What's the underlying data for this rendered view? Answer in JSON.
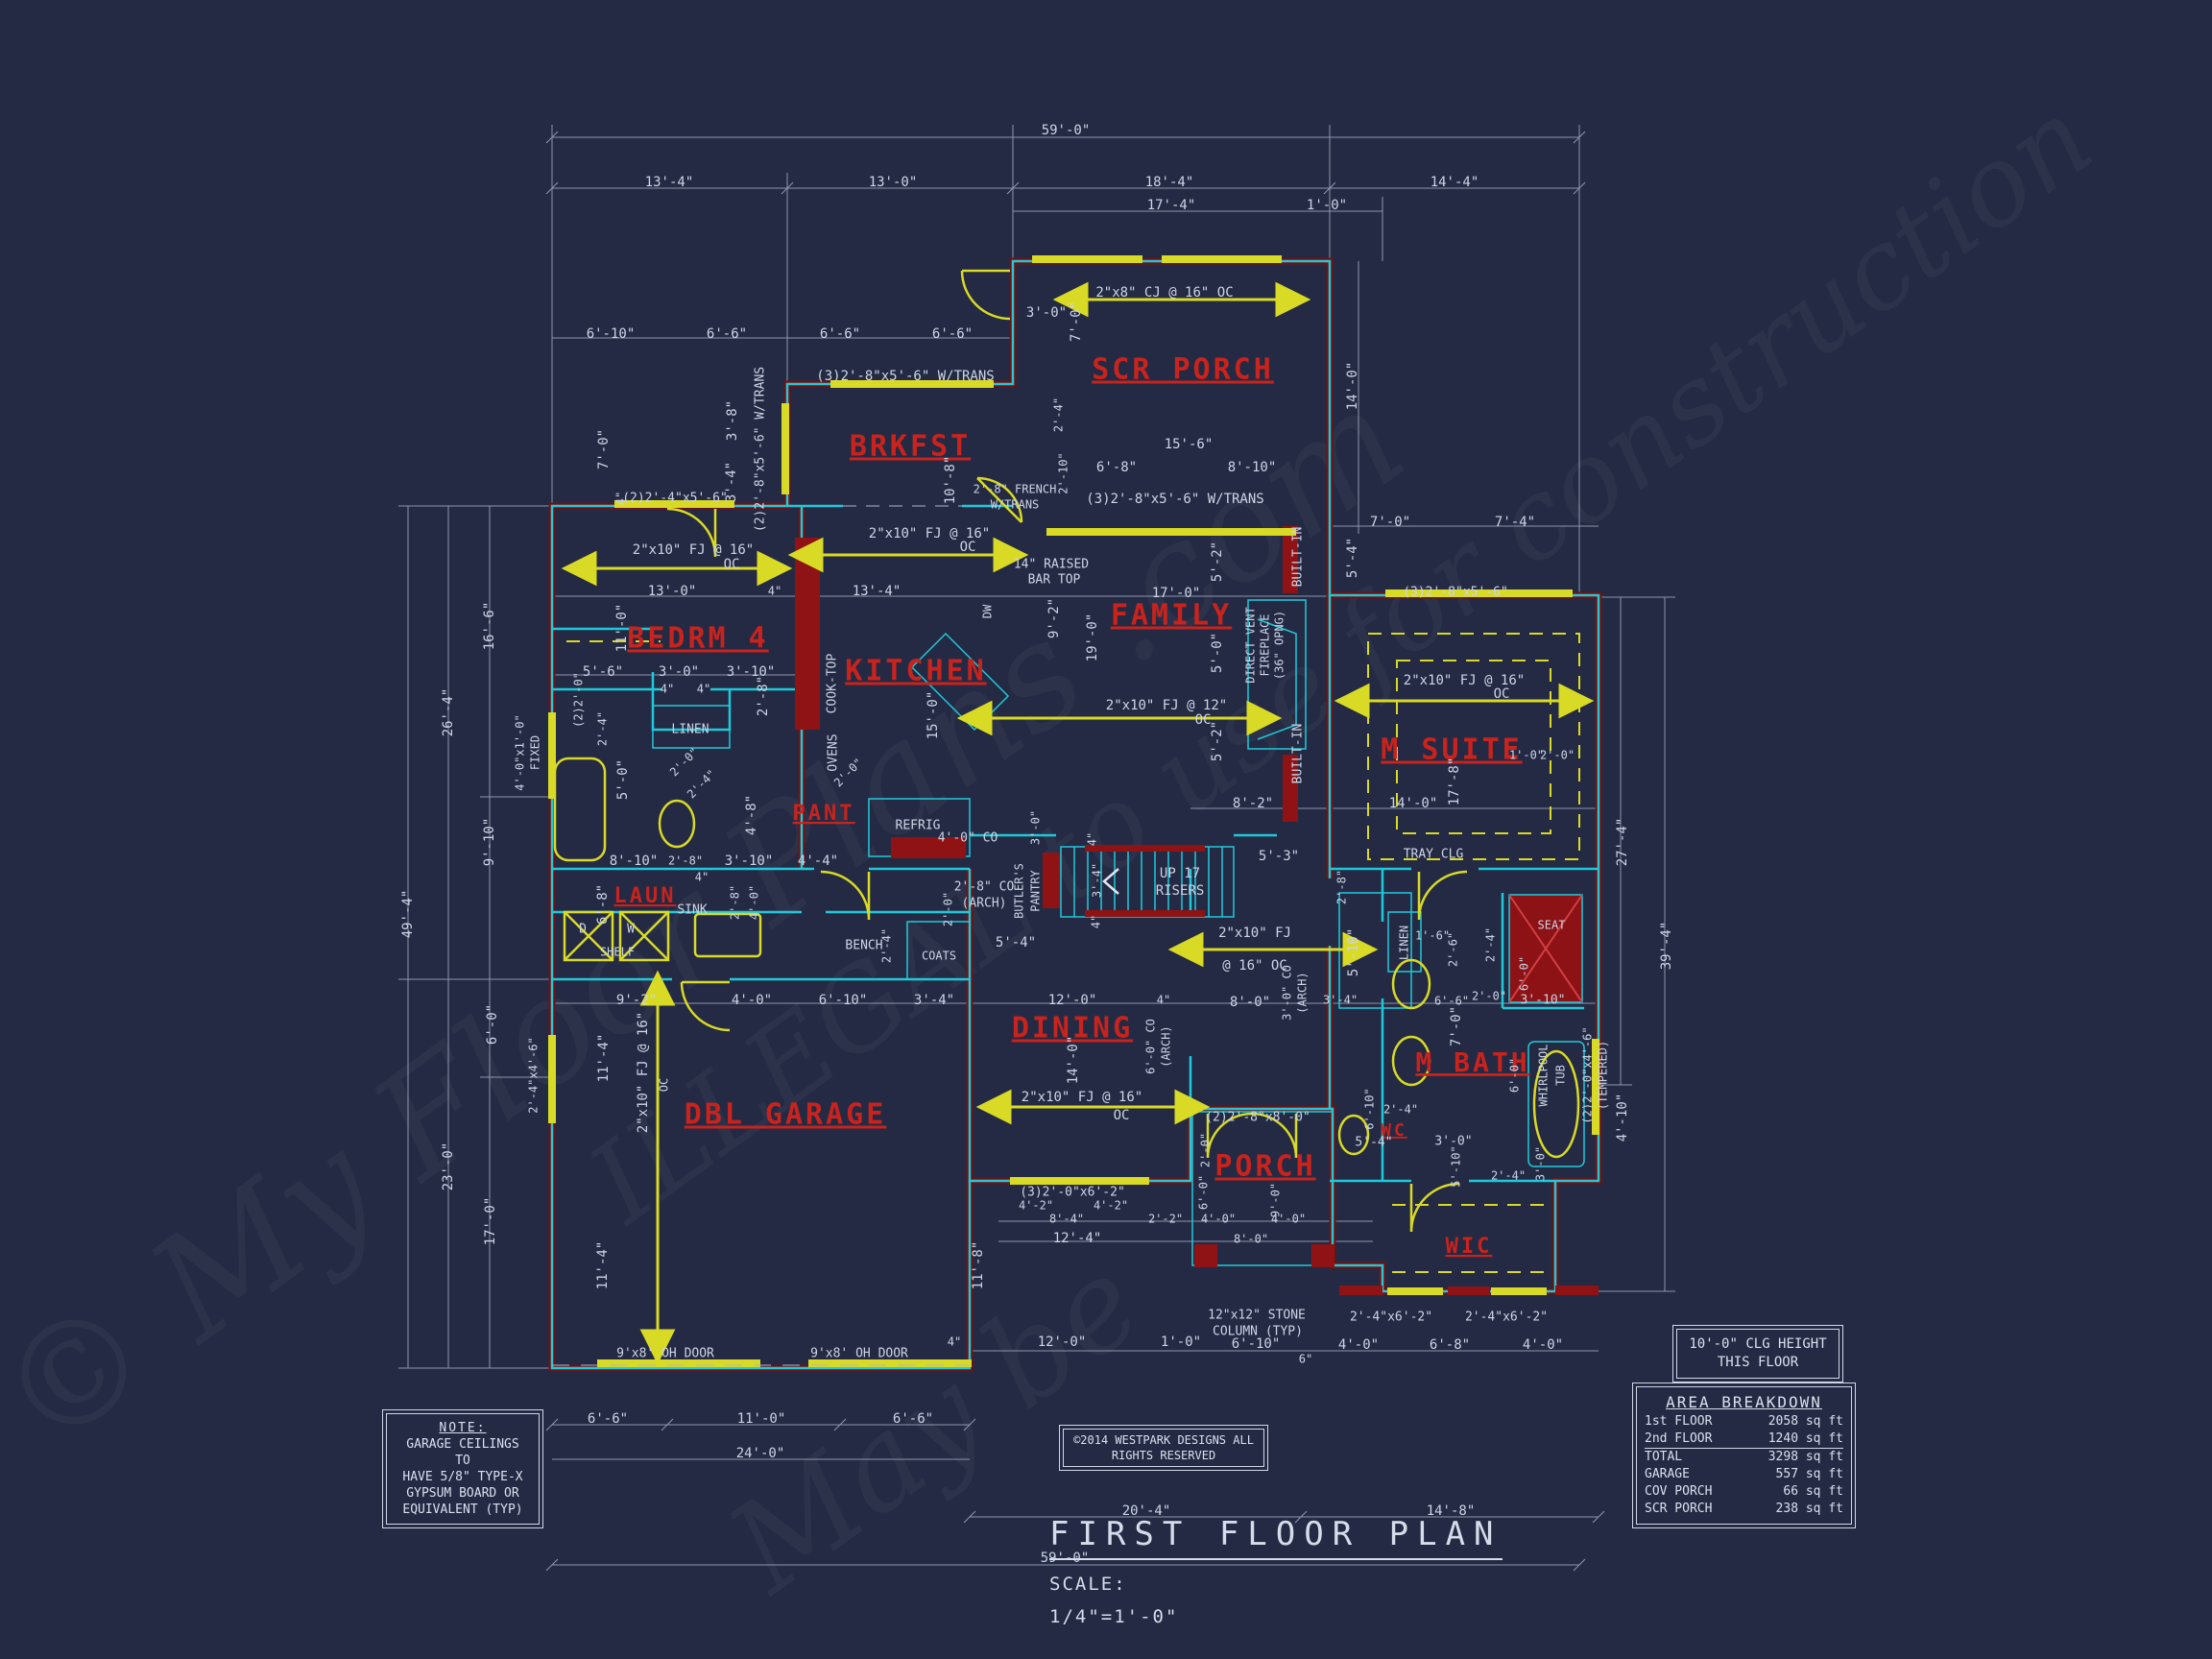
{
  "header": {
    "title": "FIRST FLOOR PLAN",
    "scale_label": "SCALE:",
    "scale_value": "1/4\"=1'-0\""
  },
  "note_box": {
    "heading": "NOTE:",
    "lines": [
      "GARAGE CEILINGS TO",
      "HAVE 5/8\" TYPE-X",
      "GYPSUM BOARD OR",
      "EQUIVALENT (TYP)"
    ]
  },
  "clg_box": {
    "line1": "10'-0\" CLG HEIGHT",
    "line2": "THIS FLOOR"
  },
  "copyright_box": {
    "line1": "©2014 WESTPARK DESIGNS ALL",
    "line2": "RIGHTS RESERVED"
  },
  "area_table": {
    "title": "AREA BREAKDOWN",
    "rows": [
      {
        "label": "1st FLOOR",
        "value": "2058 sq ft"
      },
      {
        "label": "2nd FLOOR",
        "value": "1240 sq ft"
      },
      {
        "label": "TOTAL",
        "value": "3298 sq ft"
      },
      {
        "label": "GARAGE",
        "value": "557 sq ft"
      },
      {
        "label": "COV PORCH",
        "value": "66 sq ft"
      },
      {
        "label": "SCR PORCH",
        "value": "238 sq ft"
      }
    ]
  },
  "watermarks": [
    {
      "t": "© My Floor Plans .com"
    },
    {
      "t": "ILLEGAL to use for construction"
    },
    {
      "t": "May be"
    }
  ],
  "plan_labels": [
    [
      "SCR PORCH",
      1232,
      386,
      0,
      30,
      "r"
    ],
    [
      "BRKFST",
      948,
      466,
      0,
      30,
      "r"
    ],
    [
      "BEDRM 4",
      727,
      666,
      0,
      30,
      "r"
    ],
    [
      "KITCHEN",
      954,
      700,
      0,
      30,
      "r"
    ],
    [
      "FAMILY",
      1220,
      642,
      0,
      30,
      "r"
    ],
    [
      "M SUITE",
      1512,
      782,
      0,
      30,
      "r"
    ],
    [
      "DINING",
      1117,
      1072,
      0,
      30,
      "r"
    ],
    [
      "DBL GARAGE",
      818,
      1162,
      0,
      30,
      "r"
    ],
    [
      "PORCH",
      1318,
      1216,
      0,
      30,
      "r"
    ],
    [
      "M BATH",
      1534,
      1108,
      0,
      28,
      "r"
    ],
    [
      "PANT",
      858,
      848,
      0,
      22,
      "r"
    ],
    [
      "LAUN",
      672,
      934,
      0,
      22,
      "r"
    ],
    [
      "WC",
      1452,
      1178,
      0,
      18,
      "r"
    ],
    [
      "WIC",
      1530,
      1299,
      0,
      22,
      "r"
    ],
    [
      "59'-0\"",
      1110,
      136
    ],
    [
      "13'-4\"",
      697,
      190
    ],
    [
      "13'-0\"",
      930,
      190
    ],
    [
      "18'-4\"",
      1218,
      190
    ],
    [
      "14'-4\"",
      1515,
      190
    ],
    [
      "17'-4\"",
      1220,
      214
    ],
    [
      "1'-0\"",
      1382,
      214
    ],
    [
      "2\"x8\" CJ @ 16\" OC",
      1213,
      305
    ],
    [
      "3'-0\"",
      1090,
      326
    ],
    [
      "7'-0\"",
      1121,
      335,
      -90
    ],
    [
      "14'-0\"",
      1409,
      402,
      -90
    ],
    [
      "2'-4\"",
      1103,
      432,
      -90,
      12
    ],
    [
      "2'-10\"",
      1108,
      493,
      -90,
      12
    ],
    [
      "15'-6\"",
      1238,
      463
    ],
    [
      "6'-8\"",
      1163,
      487
    ],
    [
      "8'-10\"",
      1304,
      487
    ],
    [
      "(3)2'-8\"x5'-6\" W/TRANS",
      1224,
      520
    ],
    [
      "6'-10\"",
      636,
      348
    ],
    [
      "6'-6\"",
      757,
      348
    ],
    [
      "6'-6\"",
      875,
      348
    ],
    [
      "6'-6\"",
      992,
      348
    ],
    [
      "7'-0\"",
      629,
      468,
      -90
    ],
    [
      "3'-8\"",
      763,
      438,
      -90
    ],
    [
      "3'-4\"",
      762,
      502,
      -90
    ],
    [
      "4\"",
      647,
      519,
      -90,
      12
    ],
    [
      "(2)2'-8\"x5'-6\" W/TRANS",
      792,
      468,
      -90,
      13
    ],
    [
      "(2)2'-4\"x5'-6\"",
      703,
      519,
      0,
      13
    ],
    [
      "(3)2'-8\"x5'-6\" W/TRANS",
      943,
      392
    ],
    [
      "10'-8\"",
      990,
      500,
      -90
    ],
    [
      "2'-8\" FRENCH",
      1057,
      510,
      0,
      12
    ],
    [
      "W/TRANS",
      1057,
      526,
      0,
      12
    ],
    [
      "2\"x10\" FJ @ 16\"",
      968,
      556
    ],
    [
      "OC",
      1008,
      570
    ],
    [
      "2\"x10\" FJ @ 16\"",
      722,
      573
    ],
    [
      "OC",
      762,
      588
    ],
    [
      "14\" RAISED",
      1095,
      588,
      0,
      13
    ],
    [
      "BAR TOP",
      1098,
      604,
      0,
      13
    ],
    [
      "13'-0\"",
      700,
      616
    ],
    [
      "4\"",
      807,
      616,
      0,
      12
    ],
    [
      "13'-4\"",
      913,
      616
    ],
    [
      "11'-0\"",
      648,
      654,
      -90
    ],
    [
      "9'-2\"",
      1098,
      644,
      -90
    ],
    [
      "19'-0\"",
      1138,
      664,
      -90
    ],
    [
      "DW",
      1029,
      637,
      -90,
      12
    ],
    [
      "5'-6\"",
      628,
      700
    ],
    [
      "3'-0\"",
      707,
      700
    ],
    [
      "3'-10\"",
      782,
      700
    ],
    [
      "4\"",
      695,
      718,
      0,
      12
    ],
    [
      "4\"",
      733,
      718,
      0,
      12
    ],
    [
      "2'-8\"",
      795,
      725,
      -90
    ],
    [
      "(2)2'-0\"",
      603,
      729,
      -90,
      12
    ],
    [
      "2'-4\"",
      628,
      759,
      -90,
      12
    ],
    [
      "LINEN",
      719,
      760,
      0,
      13
    ],
    [
      "5'-0\"",
      649,
      812,
      -90
    ],
    [
      "2'-0\"",
      713,
      794,
      -45,
      12
    ],
    [
      "2'-4\"",
      731,
      817,
      -45,
      12
    ],
    [
      "2'-0\"",
      884,
      805,
      -45,
      12
    ],
    [
      "COOK-TOP",
      867,
      712,
      -90,
      13
    ],
    [
      "OVENS",
      868,
      784,
      -90,
      13
    ],
    [
      "15'-0\"",
      972,
      745,
      -90
    ],
    [
      "4'-8\"",
      783,
      849,
      -90
    ],
    [
      "REFRIG",
      956,
      860,
      0,
      13
    ],
    [
      "17'-0\"",
      1225,
      618
    ],
    [
      "5'-2\"",
      1268,
      585,
      -90
    ],
    [
      "5'-0\"",
      1268,
      680,
      -90
    ],
    [
      "5'-2\"",
      1268,
      772,
      -90
    ],
    [
      "BUILT-IN",
      1352,
      580,
      -90,
      13
    ],
    [
      "BUILT-IN",
      1352,
      785,
      -90,
      13
    ],
    [
      "DIRECT VENT",
      1303,
      672,
      -90,
      12
    ],
    [
      "FIREPLACE",
      1318,
      672,
      -90,
      12
    ],
    [
      "(36\" OPNG)",
      1333,
      672,
      -90,
      12
    ],
    [
      "2\"x10\" FJ @ 12\"",
      1215,
      735
    ],
    [
      "OC",
      1253,
      750
    ],
    [
      "7'-0\"",
      1448,
      544
    ],
    [
      "7'-4\"",
      1578,
      544
    ],
    [
      "5'-4\"",
      1409,
      581,
      -90
    ],
    [
      "(3)2'-8\"x5'-6\"",
      1516,
      617,
      0,
      13
    ],
    [
      "2\"x10\" FJ @ 16\"",
      1525,
      709
    ],
    [
      "OC",
      1564,
      723
    ],
    [
      "1'-0\"",
      1590,
      787,
      0,
      12
    ],
    [
      "2'-0\"",
      1622,
      787,
      0,
      12
    ],
    [
      "17'-8\"",
      1515,
      814,
      -90
    ],
    [
      "8'-2\"",
      1305,
      837
    ],
    [
      "14'-0\"",
      1472,
      837
    ],
    [
      "TRAY CLG",
      1493,
      890,
      0,
      13
    ],
    [
      "27'-4\"",
      1690,
      877,
      -90
    ],
    [
      "39'-4\"",
      1736,
      985,
      -90
    ],
    [
      "8'-10\"",
      660,
      897
    ],
    [
      "2'-8\"",
      714,
      897,
      0,
      12
    ],
    [
      "3'-10\"",
      780,
      897
    ],
    [
      "4'-4\"",
      852,
      897
    ],
    [
      "4\"",
      731,
      914,
      0,
      12
    ],
    [
      "6'-8\"",
      628,
      942,
      -90
    ],
    [
      "2'-8\"",
      766,
      940,
      -90,
      12
    ],
    [
      "4'-0\"",
      786,
      940,
      -90,
      12
    ],
    [
      "SINK",
      721,
      948,
      0,
      13
    ],
    [
      "D",
      607,
      968,
      0,
      13
    ],
    [
      "W",
      657,
      968,
      0,
      13
    ],
    [
      "SHELF",
      643,
      992,
      0,
      12
    ],
    [
      "BENCH",
      900,
      985,
      0,
      13
    ],
    [
      "2'-4\"",
      924,
      985,
      -90,
      12
    ],
    [
      "2'-0\"",
      988,
      947,
      -90,
      12
    ],
    [
      "COATS",
      978,
      996,
      0,
      12
    ],
    [
      "4'-0\" CO",
      1008,
      873,
      0,
      13
    ],
    [
      "3'-0\"",
      1079,
      862,
      -90,
      12
    ],
    [
      "2'-8\" CO",
      1025,
      924,
      0,
      13
    ],
    [
      "(ARCH)",
      1025,
      941,
      0,
      13
    ],
    [
      "BUTLER'S",
      1062,
      928,
      -90,
      12
    ],
    [
      "PANTRY",
      1079,
      928,
      -90,
      12
    ],
    [
      "4\"",
      1138,
      874,
      -90,
      12
    ],
    [
      "3'-4\"",
      1143,
      917,
      -90,
      12
    ],
    [
      "4\"",
      1142,
      960,
      -90,
      12
    ],
    [
      "UP 17",
      1229,
      910
    ],
    [
      "RISERS",
      1229,
      928
    ],
    [
      "5'-3\"",
      1332,
      892
    ],
    [
      "5'-4\"",
      1058,
      982
    ],
    [
      "2'-8\"",
      1398,
      924,
      -90,
      12
    ],
    [
      "5'-10\"",
      1410,
      992,
      -90
    ],
    [
      "2\"x10\" FJ",
      1307,
      972
    ],
    [
      "@ 16\" OC",
      1307,
      1006
    ],
    [
      "3'-0\" CO",
      1341,
      1034,
      -90,
      12
    ],
    [
      "(ARCH)",
      1357,
      1034,
      -90,
      12
    ],
    [
      "12'-0\"",
      1117,
      1042
    ],
    [
      "4\"",
      1212,
      1042,
      0,
      12
    ],
    [
      "8'-0\"",
      1302,
      1044
    ],
    [
      "3'-4\"",
      1396,
      1042,
      0,
      12
    ],
    [
      "14'-0\"",
      1118,
      1104,
      -90
    ],
    [
      "6'-0\" CO",
      1199,
      1090,
      -90,
      12
    ],
    [
      "(ARCH)",
      1215,
      1090,
      -90,
      12
    ],
    [
      "2\"x10\" FJ @ 16\"",
      1127,
      1143
    ],
    [
      "OC",
      1168,
      1162
    ],
    [
      "(2)2'-8\"x8'-0\"",
      1310,
      1164,
      0,
      13
    ],
    [
      "9'-2\"",
      663,
      1042
    ],
    [
      "4'-0\"",
      783,
      1042
    ],
    [
      "6'-10\"",
      878,
      1042
    ],
    [
      "3'-4\"",
      973,
      1042
    ],
    [
      "11'-4\"",
      629,
      1102,
      -90
    ],
    [
      "2\"x10\" FJ @ 16\"",
      670,
      1117,
      -90
    ],
    [
      "OC",
      692,
      1130,
      -90,
      12
    ],
    [
      "11'-4\"",
      628,
      1318,
      -90
    ],
    [
      "11'-8\"",
      1019,
      1318,
      -90
    ],
    [
      "9'x8' OH DOOR",
      693,
      1410,
      0,
      13
    ],
    [
      "9'x8' OH DOOR",
      895,
      1410,
      0,
      13
    ],
    [
      "4\"",
      994,
      1398,
      0,
      12
    ],
    [
      "6'-6\"",
      633,
      1478
    ],
    [
      "11'-0\"",
      793,
      1478
    ],
    [
      "6'-6\"",
      951,
      1478
    ],
    [
      "24'-0\"",
      792,
      1514
    ],
    [
      "2'-0\"",
      1256,
      1198,
      -90,
      12
    ],
    [
      "6'-0\"",
      1254,
      1242,
      -90,
      12
    ],
    [
      "9'-0\"",
      1329,
      1250,
      -90,
      12
    ],
    [
      "(3)2'-0\"x6'-2\"",
      1117,
      1242,
      0,
      13
    ],
    [
      "4'-2\"",
      1079,
      1256,
      0,
      12
    ],
    [
      "4'-2\"",
      1157,
      1256,
      0,
      12
    ],
    [
      "8'-4\"",
      1111,
      1270,
      0,
      12
    ],
    [
      "2'-2\"",
      1214,
      1270,
      0,
      12
    ],
    [
      "4'-0\"",
      1269,
      1270,
      0,
      12
    ],
    [
      "4'-0\"",
      1342,
      1270,
      0,
      12
    ],
    [
      "8'-0\"",
      1303,
      1291,
      0,
      12
    ],
    [
      "12'-4\"",
      1122,
      1290
    ],
    [
      "12\"x12\" STONE",
      1309,
      1370,
      0,
      13
    ],
    [
      "COLUMN (TYP)",
      1310,
      1387,
      0,
      13
    ],
    [
      "12'-0\"",
      1106,
      1398
    ],
    [
      "1'-0\"",
      1230,
      1398
    ],
    [
      "6'-10\"",
      1308,
      1400
    ],
    [
      "6\"",
      1360,
      1416,
      0,
      12
    ],
    [
      "4'-0\"",
      1415,
      1401
    ],
    [
      "6'-8\"",
      1510,
      1401
    ],
    [
      "4'-0\"",
      1607,
      1401
    ],
    [
      "2'-4\"x6'-2\"",
      1449,
      1372,
      0,
      13
    ],
    [
      "2'-4\"x6'-2\"",
      1569,
      1372,
      0,
      13
    ],
    [
      "20'-4\"",
      1194,
      1574
    ],
    [
      "14'-8\"",
      1511,
      1574
    ],
    [
      "59'-0\"",
      1109,
      1623
    ],
    [
      "LINEN",
      1463,
      982,
      -90,
      12
    ],
    [
      "1'-6\"",
      1492,
      975,
      0,
      12
    ],
    [
      "2'-6\"",
      1514,
      989,
      -90,
      12
    ],
    [
      "2'-4\"",
      1553,
      984,
      -90,
      12
    ],
    [
      "SEAT",
      1616,
      964,
      0,
      12
    ],
    [
      "6'-0\"",
      1588,
      1014,
      -90,
      12
    ],
    [
      "3'-10\"",
      1607,
      1042,
      0,
      13
    ],
    [
      "2'-0\"",
      1551,
      1038,
      0,
      12
    ],
    [
      "6'-6\"",
      1512,
      1043,
      0,
      12
    ],
    [
      "7'-0\"",
      1517,
      1069,
      -90
    ],
    [
      "6'-0\"",
      1578,
      1120,
      -90,
      12
    ],
    [
      "WHIRLPOOL",
      1608,
      1120,
      -90,
      12
    ],
    [
      "TUB",
      1626,
      1120,
      -90,
      12
    ],
    [
      "(2)2'-0\"x4'-6\"",
      1654,
      1120,
      -90,
      12
    ],
    [
      "(TEMPERED)",
      1670,
      1120,
      -90,
      12
    ],
    [
      "4'-10\"",
      1690,
      1164,
      -90
    ],
    [
      "6'-10\"",
      1427,
      1155,
      -90,
      12
    ],
    [
      "2'-4\"",
      1459,
      1156,
      0,
      12
    ],
    [
      "5'-4\"",
      1431,
      1190,
      0,
      13
    ],
    [
      "3'-0\"",
      1514,
      1189,
      0,
      13
    ],
    [
      "5'-10\"",
      1517,
      1215,
      -90,
      12
    ],
    [
      "2'-4\"",
      1571,
      1225,
      0,
      12
    ],
    [
      "3'-0\"",
      1605,
      1212,
      -90,
      12
    ],
    [
      "49'-4\"",
      425,
      952,
      -90
    ],
    [
      "26'-4\"",
      467,
      742,
      -90
    ],
    [
      "23'-0\"",
      467,
      1215,
      -90
    ],
    [
      "16'-6\"",
      510,
      652,
      -90
    ],
    [
      "9'-10\"",
      510,
      877,
      -90
    ],
    [
      "6'-0\"",
      513,
      1067,
      -90
    ],
    [
      "17'-0\"",
      511,
      1272,
      -90
    ],
    [
      "4'-0\"x1'-0\"",
      542,
      784,
      -90,
      12
    ],
    [
      "FIXED",
      558,
      784,
      -90,
      12
    ],
    [
      "2'-4\"x4'-6\"",
      556,
      1120,
      -90,
      12
    ]
  ]
}
